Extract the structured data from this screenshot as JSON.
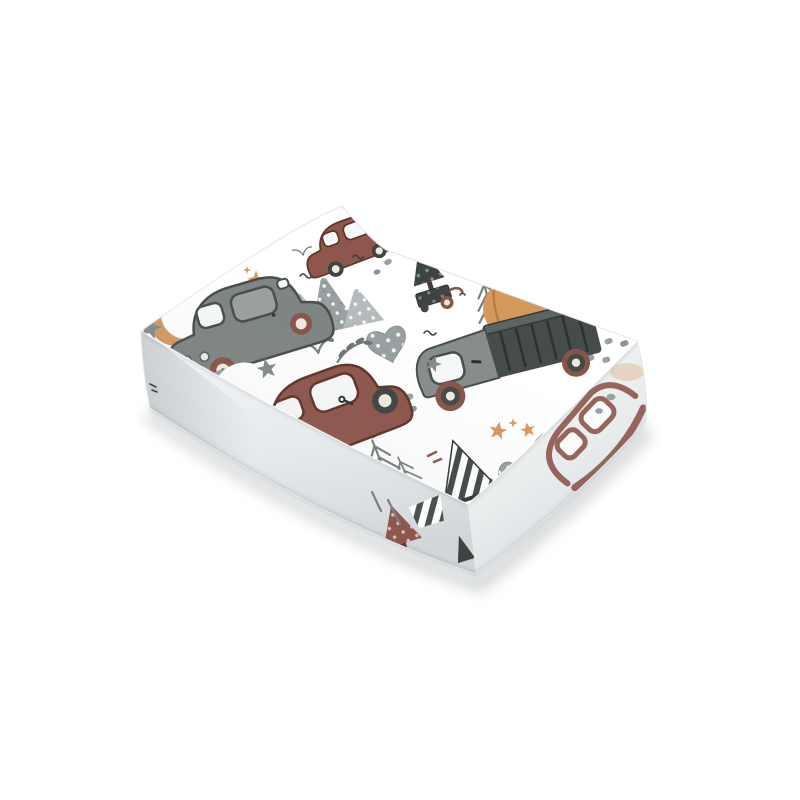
{
  "page": {
    "background": "#ffffff",
    "description": "Product photo of a folded fitted baby sheet with a watercolor cars-and-forest pattern, shown at a three-quarter angle on a plain white background",
    "object_type": "folded-fabric-sheet"
  },
  "product": {
    "pattern_theme": "watercolor retro cars, pickup truck with pumpkin, pine trees, mountains, moons and stars on white fabric",
    "aria_label": "Folded white baby sheet printed with watercolor cars, trucks, trees, mountains, moons and stars"
  },
  "palette": {
    "fabric": "#ffffff",
    "car_gray": "#7e8583",
    "car_gray_dark": "#474e4c",
    "car_maroon": "#8e564c",
    "car_maroon_dark": "#5f332a",
    "window": "#f7f8f8",
    "window_dark": "#9aa09d",
    "truck_gray": "#868d8b",
    "bed_dark": "#454c4a",
    "wheel_maroon": "#8a544a",
    "wheel_cream": "#efe9df",
    "wheel_dark": "#3f4543",
    "orange": "#d6995c",
    "orange_deep": "#b97d40",
    "orange_moon": "#d09a62",
    "stem_dark": "#3a403e",
    "moon_gray": "#9aa1a3",
    "star_gray": "#848b8d",
    "mtn_light": "#b5babc",
    "mtn_mid": "#99a0a2",
    "tree_dark": "#3d4442",
    "tree_mid": "#5a6260",
    "tree_sketch": "#788080",
    "pebble": "#9aa1a3",
    "leaf": "#6e7674",
    "stripe_dark": "#2e3432"
  },
  "motifs": [
    {
      "name": "gray-car",
      "color_key": "car_gray"
    },
    {
      "name": "maroon-car",
      "color_key": "car_maroon"
    },
    {
      "name": "small-maroon-car",
      "color_key": "car_maroon"
    },
    {
      "name": "pickup-truck-with-pumpkin",
      "color_key": "truck_gray"
    },
    {
      "name": "tree-on-cart",
      "color_key": "tree_dark"
    },
    {
      "name": "dotted-mountains",
      "color_key": "mtn_light"
    },
    {
      "name": "orange-crescent-moon",
      "color_key": "orange_moon"
    },
    {
      "name": "gray-crescent-moon",
      "color_key": "moon_gray"
    },
    {
      "name": "striped-tent-tree",
      "color_key": "stripe_dark"
    },
    {
      "name": "sketchy-pine-trees",
      "color_key": "tree_sketch"
    },
    {
      "name": "pine-cones",
      "color_key": "moon_gray"
    },
    {
      "name": "dotted-heart",
      "color_key": "mtn_mid"
    },
    {
      "name": "stars",
      "color_key": "star_gray"
    },
    {
      "name": "road-pebbles",
      "color_key": "pebble"
    },
    {
      "name": "tiny-birds",
      "color_key": "tree_dark"
    }
  ]
}
